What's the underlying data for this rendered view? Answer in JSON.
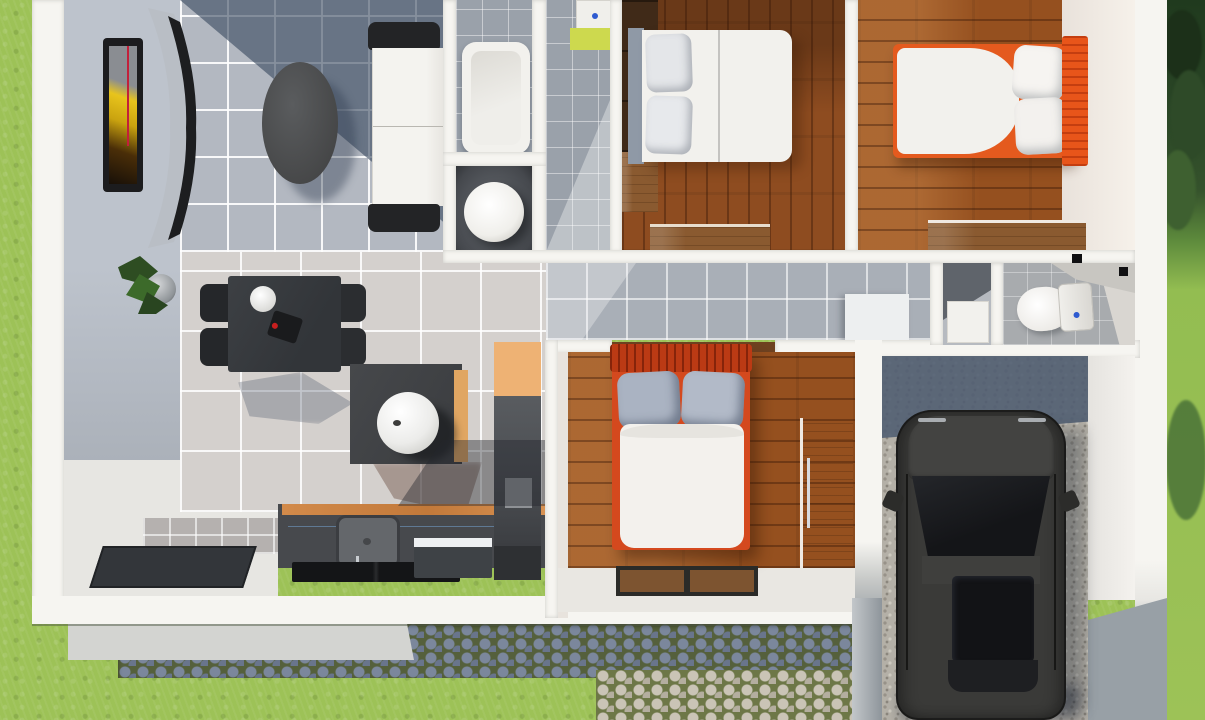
{
  "scene": {
    "title": "3D top-down floor plan render of a small house",
    "style": "isometric architectural visualization, no visible text",
    "house": {
      "rooms": [
        {
          "name": "living-dining-room",
          "floor": "ceramic tile (cool gray / warm beige)",
          "furniture": [
            "wall-art-frame",
            "curved-tv-console",
            "oval-coffee-table",
            "white-sofa-black-arms",
            "potted-plant",
            "dining-table-with-4-black-chairs",
            "side-table-with-sphere-lamp",
            "entry-door-mat"
          ]
        },
        {
          "name": "kitchen",
          "floor": "white screed",
          "furniture": [
            "dark-counter-with-wood-edge",
            "square-sink-with-faucet",
            "black-cooktop",
            "dishwasher-white-top",
            "tall-fridge-unit",
            "tan-upper-cabinet"
          ]
        },
        {
          "name": "bathroom",
          "floor": "gray tile",
          "furniture": [
            "bathtub",
            "vanity-sink-lime-cabinet",
            "cylinder-toilet-stall"
          ]
        },
        {
          "name": "bedroom-top-middle",
          "floor": "wood planks (vertical)",
          "furniture": [
            "double-bed-gray-headboard",
            "dark-wardrobe",
            "wood-nightstand",
            "wood-dresser"
          ]
        },
        {
          "name": "bedroom-top-right",
          "floor": "wood planks (horizontal)",
          "furniture": [
            "double-bed-orange-headboard",
            "wood-dresser"
          ]
        },
        {
          "name": "bedroom-bottom-middle",
          "floor": "wood planks (horizontal)",
          "furniture": [
            "double-bed-orange-headboard-gray-pillows",
            "wood-wardrobe",
            "two-brown-door-mats"
          ]
        },
        {
          "name": "hallway",
          "floor": "gray tile",
          "furniture": [
            "white-appliance-box"
          ]
        },
        {
          "name": "shower-room",
          "floor": "gray",
          "furniture": [
            "white-shower-tray"
          ]
        },
        {
          "name": "wc",
          "floor": "gray tile",
          "furniture": [
            "toilet-with-tank-blue-button"
          ]
        },
        {
          "name": "garage-carport",
          "floor": "gravel",
          "furniture": [
            "dark-suv-car"
          ]
        }
      ]
    },
    "exterior": [
      "lawn-grass-left",
      "lawn-and-trees-right",
      "dark-cobblestone-path",
      "light-cobblestone-path",
      "concrete-step-slab",
      "white-perimeter-walls",
      "gravel-driveway"
    ],
    "palette": {
      "grass": "#9dc257",
      "trees_dark": "#243d22",
      "tile_cool": "#b3b8c1",
      "tile_warm": "#d4d0cd",
      "tile_bath": "#9aa1aa",
      "wood_floor": "#95501f",
      "wood_furniture": "#8a5a30",
      "wall_white": "#f6f5f1",
      "shadow_slate": "#3a495f",
      "bed_orange": "#e45a1e",
      "bed_red_orange": "#c03f16",
      "pillow_gray": "#aab3c2",
      "duvet_white": "#f2f1ed",
      "counter_dark": "#47494d",
      "counter_wood_edge": "#d28a4a",
      "vanity_lime": "#cdd94e",
      "car_body": "#3a3a38",
      "car_glass": "#16171a",
      "gravel": "#b4b0a7",
      "cobble_dark": "#69758c",
      "cobble_light": "#c1bbad",
      "accent_blue_dot": "#2f5bd0"
    }
  }
}
